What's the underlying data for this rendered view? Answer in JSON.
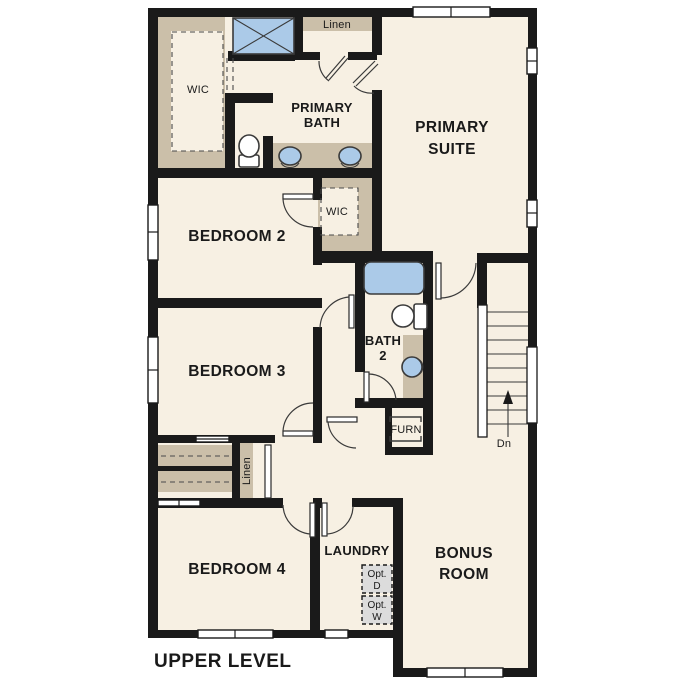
{
  "plan": {
    "title": "UPPER LEVEL"
  },
  "rooms": {
    "primary_suite": {
      "line1": "PRIMARY",
      "line2": "SUITE"
    },
    "primary_bath": {
      "line1": "PRIMARY",
      "line2": "BATH"
    },
    "bedroom_2": {
      "label": "BEDROOM 2"
    },
    "bedroom_3": {
      "label": "BEDROOM 3"
    },
    "bedroom_4": {
      "label": "BEDROOM 4"
    },
    "bonus_room": {
      "line1": "BONUS",
      "line2": "ROOM"
    },
    "laundry": {
      "label": "LAUNDRY"
    },
    "bath_2": {
      "line1": "BATH",
      "line2": "2"
    }
  },
  "closets": {
    "wic_primary": {
      "label": "WIC"
    },
    "wic_bedroom_2": {
      "label": "WIC"
    },
    "linen_upper": {
      "label": "Linen"
    },
    "linen_hall": {
      "label": "Linen"
    },
    "furnace": {
      "label": "FURN"
    }
  },
  "appliances": {
    "optional_dryer": {
      "line1": "Opt.",
      "line2": "D"
    },
    "optional_washer": {
      "line1": "Opt.",
      "line2": "W"
    }
  },
  "stairs": {
    "direction_label": "Dn"
  },
  "colors": {
    "background": "#ffffff",
    "wall": "#1a1a1a",
    "floor": "#f7f0e3",
    "casework": "#cbbfa9",
    "fixture_blue": "#abcae8",
    "appliance_gray": "#dcdcdc",
    "text": "#1a1a1a"
  }
}
